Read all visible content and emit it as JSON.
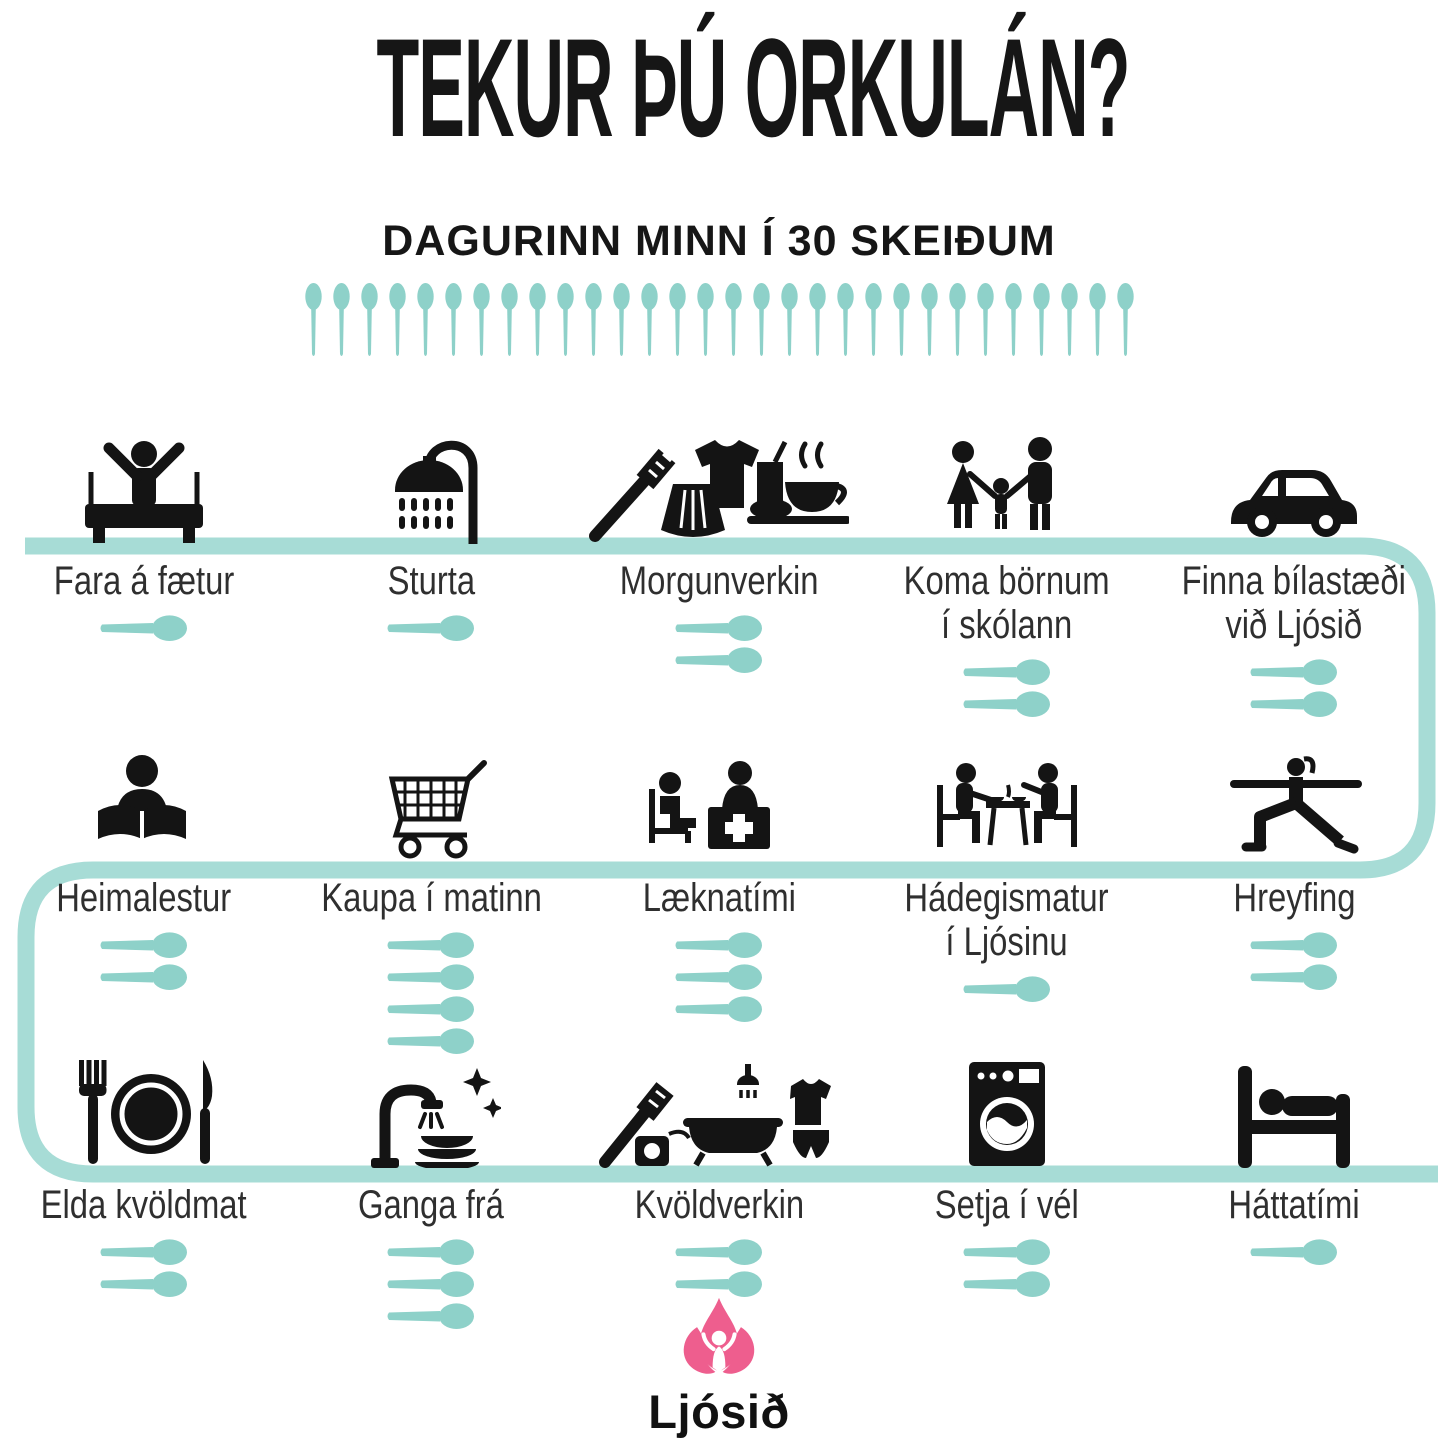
{
  "title": "TEKUR ÞÚ ORKULÁN?",
  "subtitle": "DAGURINN MINN Í 30 SKEIÐUM",
  "spoon_row": {
    "count": 30
  },
  "colors": {
    "spoon_teal": "#8ed1c9",
    "path_teal": "#a7dcd6",
    "icon_black": "#141414",
    "logo_pink": "#ee5e8e",
    "text_dark": "#2f2f2f"
  },
  "rows": [
    {
      "items": [
        {
          "label_lines": [
            "Fara á fætur"
          ],
          "spoons": 1,
          "icon": "wake-up-icon"
        },
        {
          "label_lines": [
            "Sturta"
          ],
          "spoons": 1,
          "icon": "shower-icon"
        },
        {
          "label_lines": [
            "Morgunverkin"
          ],
          "spoons": 2,
          "icon": "morning-routine-icon"
        },
        {
          "label_lines": [
            "Koma börnum",
            "í skólann"
          ],
          "spoons": 2,
          "icon": "family-icon"
        },
        {
          "label_lines": [
            "Finna bílastæði",
            "við Ljósið"
          ],
          "spoons": 2,
          "icon": "car-icon"
        }
      ]
    },
    {
      "items": [
        {
          "label_lines": [
            "Heimalestur"
          ],
          "spoons": 2,
          "icon": "reading-icon"
        },
        {
          "label_lines": [
            "Kaupa í matinn"
          ],
          "spoons": 4,
          "icon": "shopping-cart-icon"
        },
        {
          "label_lines": [
            "Læknatími"
          ],
          "spoons": 3,
          "icon": "doctor-icon"
        },
        {
          "label_lines": [
            "Hádegismatur",
            "í Ljósinu"
          ],
          "spoons": 1,
          "icon": "lunch-table-icon"
        },
        {
          "label_lines": [
            "Hreyfing"
          ],
          "spoons": 2,
          "icon": "yoga-icon"
        }
      ]
    },
    {
      "items": [
        {
          "label_lines": [
            "Elda kvöldmat"
          ],
          "spoons": 2,
          "icon": "dinner-plate-icon"
        },
        {
          "label_lines": [
            "Ganga frá"
          ],
          "spoons": 3,
          "icon": "dishes-icon"
        },
        {
          "label_lines": [
            "Kvöldverkin"
          ],
          "spoons": 2,
          "icon": "evening-routine-icon"
        },
        {
          "label_lines": [
            "Setja í vél"
          ],
          "spoons": 2,
          "icon": "washing-machine-icon"
        },
        {
          "label_lines": [
            "Háttatími"
          ],
          "spoons": 1,
          "icon": "sleep-icon"
        }
      ]
    }
  ],
  "logo": {
    "text": "Ljósið",
    "icon": "flame-icon"
  }
}
